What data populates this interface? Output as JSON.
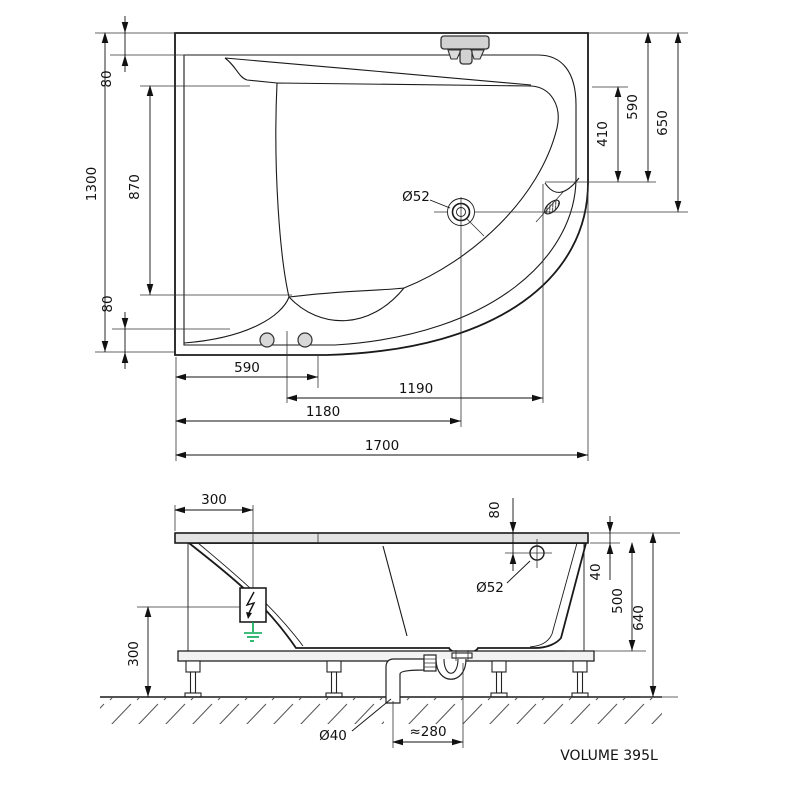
{
  "drawing": {
    "volume_label": "VOLUME 395L",
    "colors": {
      "line": "#1a1a1a",
      "tub_fill": "#ececec",
      "ground_symbol_green": "#00a651"
    },
    "top_view": {
      "dims": {
        "overall_length": "1700",
        "overall_width": "1300",
        "rim_top": "80",
        "basin_length": "870",
        "rim_bottom": "80",
        "inner_right": "590",
        "seat_right": "410",
        "corner_right": "650",
        "apron_bottom": "590",
        "drain_from_grip": "1190",
        "drain_from_left": "1180",
        "drain_label": "Ø52"
      }
    },
    "side_view": {
      "dims": {
        "box_from_edge": "300",
        "overflow_from_top": "80",
        "overflow_label": "Ø52",
        "rim_height": "40",
        "inner_depth": "500",
        "overall_height": "640",
        "box_from_floor": "300",
        "waste_label": "Ø40",
        "trap_offset": "≈280"
      }
    }
  }
}
